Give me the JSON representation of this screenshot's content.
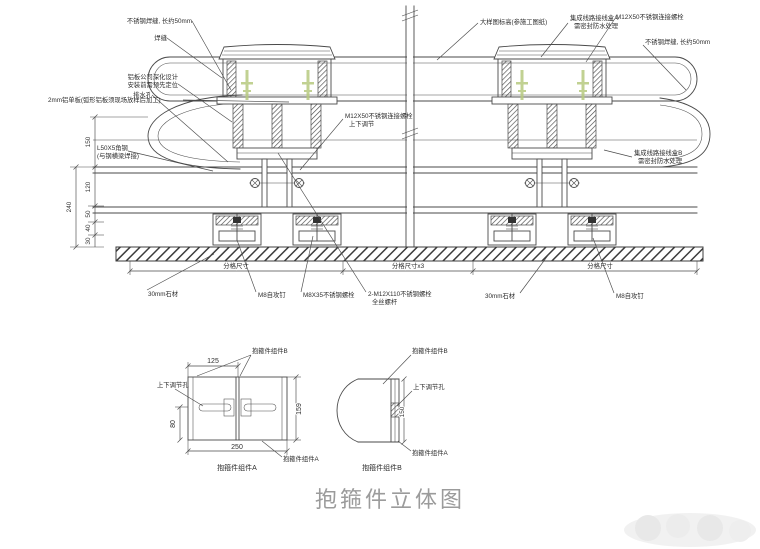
{
  "colors": {
    "line": "#4a4a4a",
    "text": "#2e2e2e",
    "green_marker": "#b7c97f",
    "caption_gray": "#9b9b9b"
  },
  "labels": {
    "weld_top_left": "不锈钢焊缝, 长约50mm",
    "weld_seam": "焊缝",
    "panel_note_1": "铝板公司深化设计",
    "panel_note_2": "安装前需预先定位",
    "drain_hole": "排水孔",
    "alum_panel": "2mm铝单板(弧形铝板须现场放样后加工)",
    "angle_steel_1": "L50X5角钢",
    "angle_steel_2": "(与钢横梁焊接)",
    "bolt_m12x50_left_1": "M12X50不锈钢连接螺栓",
    "bolt_m12x50_left_2": "上下调节",
    "elevation_note": "大样图标高(参施工图纸)",
    "junction_a_1": "集成线路接线盒A",
    "junction_a_2": "需密封防水处理",
    "bolt_m12x50_right": "M12X50不锈钢连接螺栓",
    "weld_top_right": "不锈钢焊缝, 长约50mm",
    "junction_b_1": "集成线路接线盒B",
    "junction_b_2": "需密封防水处理",
    "stone_left": "30mm石材",
    "screw_m8_left": "M8自攻钉",
    "bolt_m8x35": "M8X35不锈钢螺栓",
    "bolt_m12x110_1": "2-M12X110不锈钢螺栓",
    "bolt_m12x110_2": "全丝螺杆",
    "stone_right": "30mm石材",
    "screw_m8_right": "M8自攻钉"
  },
  "dims": {
    "d150": "150",
    "d240": "240",
    "d120": "120",
    "d50": "50",
    "d40": "40",
    "d30": "30",
    "span_left": "分格尺寸",
    "span_mid": "分格尺寸x3",
    "span_right": "分格尺寸"
  },
  "detail_a": {
    "dim_top": "125",
    "dim_right": "159",
    "dim_left": "80",
    "dim_bottom": "250",
    "label_b": "抱箍件组件B",
    "label_hole": "上下调节孔",
    "label_a": "抱箍件组件A",
    "caption": "抱箍件组件A"
  },
  "detail_b": {
    "dim": "150",
    "label_b": "抱箍件组件B",
    "label_hole": "上下调节孔",
    "label_a": "抱箍件组件A",
    "caption": "抱箍件组件B"
  },
  "caption": "抱箍件立体图"
}
